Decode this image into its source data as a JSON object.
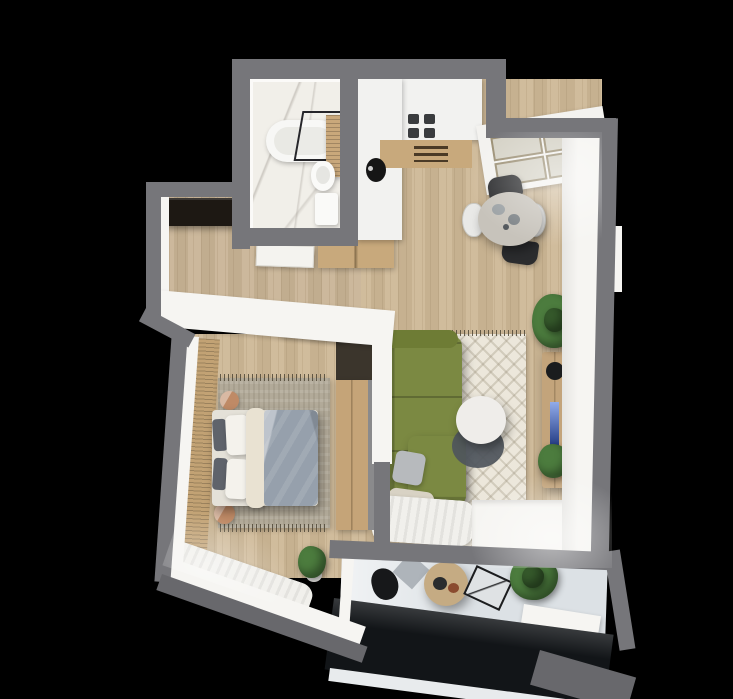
{
  "scene": {
    "kind": "3d-top-down-apartment-floorplan-render",
    "background": "#000000",
    "rooms": [
      "bathroom",
      "hallway",
      "kitchen-dining",
      "living-room",
      "bedroom",
      "balcony"
    ]
  },
  "colors": {
    "wall_outer": "#76767a",
    "wall_outer_dark": "#68686c",
    "wall_inner": "#f6f5f2",
    "floor_wood": "#cdb795",
    "floor_wood_hall": "#c8b394",
    "floor_marble": "#f1efe9",
    "floor_balcony": "#dce1e5",
    "slat_wall": "#c2a274",
    "entry_closet": "#1d1813",
    "sofa": "#7b8942",
    "sofa_arm": "#6e7c35",
    "sofa_pillow": "#b7babd",
    "sofa_throw": "#d8d2c4",
    "bed_base": "#e4e1d8",
    "bed_duvet": "#96a0ac",
    "bed_pillow_dark": "#5f636b",
    "bed_pillow_white": "#f4f2ec",
    "bed_blanket": "#e9e2d2",
    "rug_bedroom": "#b2aa99",
    "rug_living": "#ece7db",
    "side_table": "#bf8a66",
    "wardrobe_wood": "#c5a478",
    "wardrobe_dark": "#3b352c",
    "counter_white": "#f2f2f0",
    "counter_wood": "#c8a97c",
    "hob_burner": "#3a3c3e",
    "sink": "#161616",
    "window_sill": "#f3f2ef",
    "window_frame": "#9b8f74",
    "window_glass": "#d5d2c6",
    "dining_table": "#c7c3bb",
    "chair_dark": "#2b2c2e",
    "chair_white": "#e9e9e7",
    "coffee_table": "#efedea",
    "coffee_table_dark": "#4e555c",
    "tv_board": "#c3a47b",
    "tv_screen": "#2257d6",
    "speaker": "#1a1c1e",
    "plant": "#4c7c3e",
    "plant_dark": "#35592b",
    "plant_pot": "#f0efec",
    "tub": "#f7f7f5",
    "tub_inner": "#e9e9e4",
    "bath_wood": "#c9a87b",
    "toilet": "#fafaf8",
    "door": "#f4f3ef",
    "curtain": "#f1f0ec",
    "balcony_table": "#c5ab83",
    "balcony_plate_dark": "#2a2c2e",
    "balcony_plate_brown": "#8a4b2f",
    "balcony_mat": "#aeb4ba",
    "balcony_chair_dark": "#17181a",
    "balcony_chair_fold": "#dfe2e4",
    "railing_glass": "#121518",
    "railing_frame": "#e8ebed",
    "shadow_wall": "#8a8a8c"
  }
}
